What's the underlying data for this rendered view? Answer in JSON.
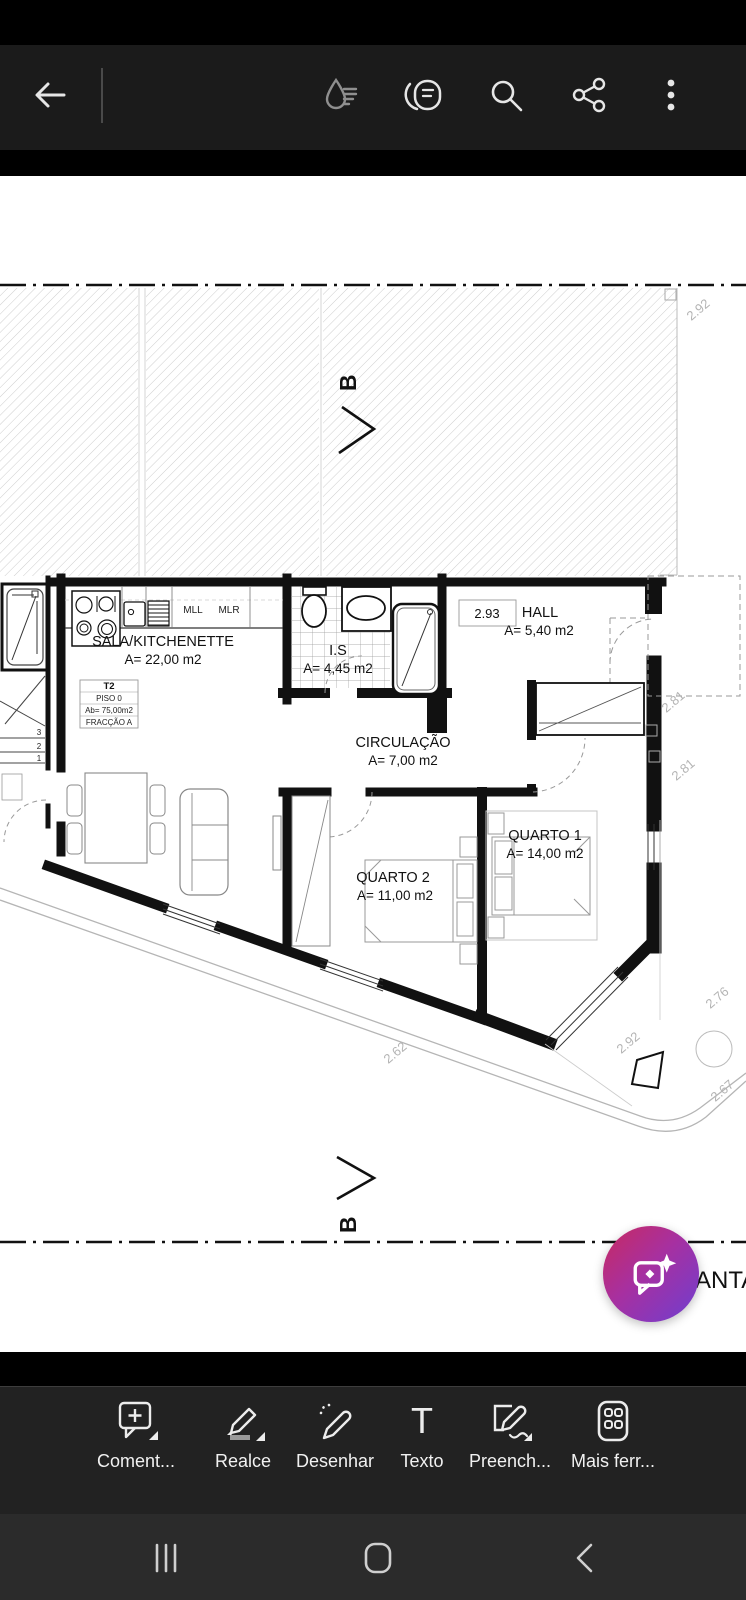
{
  "top_toolbar": {
    "icons": [
      "back-arrow",
      "liquid-mode",
      "view-settings",
      "search",
      "share",
      "more-options"
    ]
  },
  "doc": {
    "section_marker_top": "B",
    "section_marker_bottom": "B",
    "partial_title_right": "ANTA",
    "rooms": {
      "sala": {
        "name": "SALA/KITCHENETTE",
        "area": "A= 22,00 m2"
      },
      "is": {
        "name": "I.S",
        "area": "A= 4,45 m2"
      },
      "hall": {
        "name": "HALL",
        "area": "A= 5,40 m2"
      },
      "circulacao": {
        "name": "CIRCULAÇÃO",
        "area": "A= 7,00 m2"
      },
      "quarto1": {
        "name": "QUARTO 1",
        "area": "A= 14,00 m2"
      },
      "quarto2": {
        "name": "QUARTO 2",
        "area": "A= 11,00 m2"
      }
    },
    "info_box": {
      "type": "T2",
      "floor": "PISO 0",
      "gross_area": "Ab= 75,00m2",
      "fraction": "FRACÇÃO A"
    },
    "kitchen": {
      "mll": "MLL",
      "mlr": "MLR"
    },
    "dims": {
      "hall_width": "2.93",
      "top_right": "2.92",
      "right_upper": "2.81",
      "right_lower": "2.81",
      "bottom_left": "2.62",
      "bottom_center": "2.92",
      "bottom_right_upper": "2.76",
      "bottom_right_lower": "2.67"
    },
    "stairs": {
      "s1": "1",
      "s2": "2",
      "s3": "3"
    }
  },
  "tools": [
    {
      "label": "Coment...",
      "icon": "comment-plus"
    },
    {
      "label": "Realce",
      "icon": "highlighter"
    },
    {
      "label": "Desenhar",
      "icon": "draw-pen"
    },
    {
      "label": "Texto",
      "icon": "text-tool"
    },
    {
      "label": "Preench...",
      "icon": "fill-sign"
    },
    {
      "label": "Mais ferr...",
      "icon": "more-tools-grid"
    }
  ],
  "fab": {
    "icon": "ai-chat-sparkle"
  },
  "navbar": {
    "icons": [
      "recents",
      "home",
      "back"
    ]
  },
  "colors": {
    "fab_gradient_start": "#c82a60",
    "fab_gradient_end": "#6f3ed0",
    "top_toolbar_bg": "#1b1b1b",
    "bottom_toolbar_bg": "#222222",
    "nav_bar_bg": "#2b2b2b",
    "page_bg": "#ffffff"
  }
}
